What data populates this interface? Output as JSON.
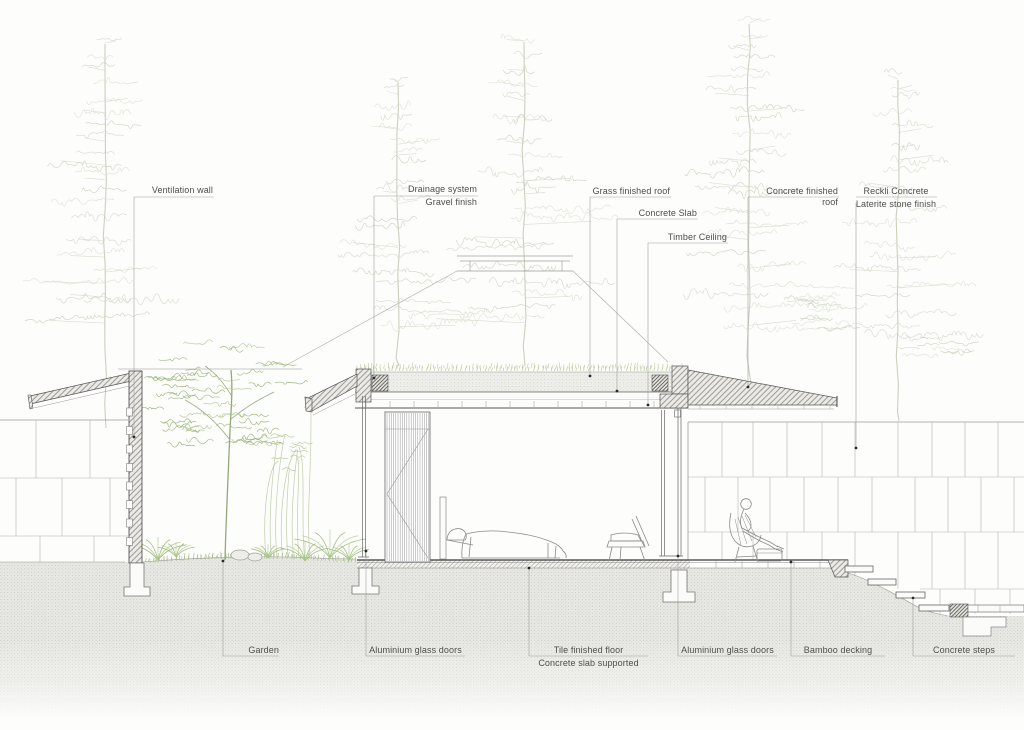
{
  "annotations": {
    "top": [
      {
        "id": "ventilation-wall",
        "line1": "Ventilation wall"
      },
      {
        "id": "drainage-system",
        "line1": "Drainage system",
        "line2": "Gravel finish"
      },
      {
        "id": "grass-finished-roof",
        "line1": "Grass finished roof"
      },
      {
        "id": "concrete-slab",
        "line1": "Concrete Slab"
      },
      {
        "id": "timber-ceiling",
        "line1": "Timber Ceiling"
      },
      {
        "id": "concrete-finished-roof",
        "line1": "Concrete finished roof"
      },
      {
        "id": "reckli-concrete",
        "line1": "Reckli Concrete",
        "line2": "Laterite stone finish"
      }
    ],
    "bottom": [
      {
        "id": "garden",
        "line1": "Garden"
      },
      {
        "id": "aluminium-glass-doors-left",
        "line1": "Aluminium glass doors"
      },
      {
        "id": "tile-finished-floor",
        "line1": "Tile finished floor",
        "line2": "Concrete slab supported"
      },
      {
        "id": "aluminium-glass-doors-right",
        "line1": "Aluminium glass doors"
      },
      {
        "id": "bamboo-decking",
        "line1": "Bamboo decking"
      },
      {
        "id": "concrete-steps",
        "line1": "Concrete steps"
      }
    ]
  },
  "colors": {
    "section_line": "#3a3a3a",
    "leader_line": "#9a9a9a",
    "label_text": "#4e4e4e",
    "earth_stipple": "#b8b8b1",
    "background_vegetation": "#ccd5c0",
    "garden_green": "#9cb77b",
    "roof_grass": "#a9ba85"
  }
}
